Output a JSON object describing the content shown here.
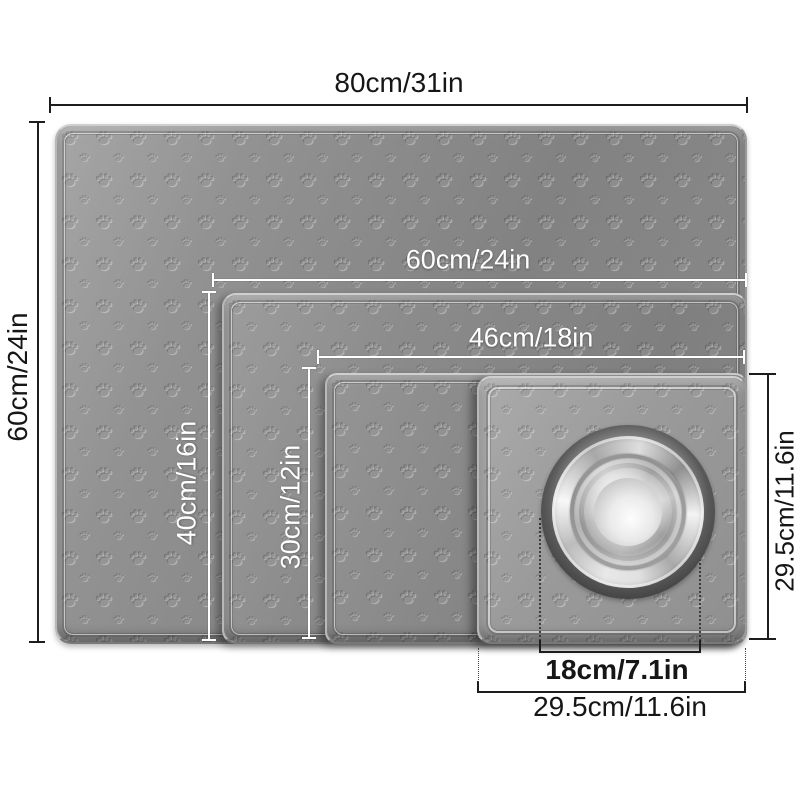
{
  "title": "Pet feeding mat size comparison diagram",
  "mats": {
    "mat_80x60": {
      "name": "extra large mat",
      "width_label": "80cm/31in",
      "height_label": "60cm/24in"
    },
    "mat_60x40": {
      "name": "large mat",
      "width_label": "60cm/24in",
      "height_label": "40cm/16in"
    },
    "mat_46x30": {
      "name": "medium mat",
      "width_label": "46cm/18in",
      "height_label": "30cm/12in"
    },
    "mat_295x295": {
      "name": "small square mat",
      "width_label": "29.5cm/11.6in",
      "height_label": "29.5cm/11.6in"
    }
  },
  "bowl": {
    "name": "stainless steel bowl",
    "diameter_label": "18cm/7.1in"
  },
  "colors": {
    "mat_gray": "#8a8a8a",
    "small_mat_gray": "#9d9d9d",
    "annotation_dark": "#1d1d1d",
    "annotation_white": "#ffffff",
    "background": "#ffffff"
  }
}
